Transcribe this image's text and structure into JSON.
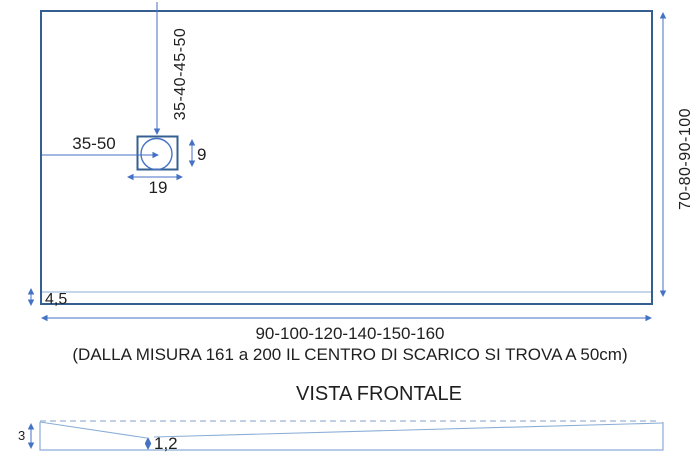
{
  "top_view": {
    "drain_center_from_top_label": "35-40-45-50",
    "drain_center_from_left_label": "35-50",
    "drain_box_height_label": "9",
    "drain_box_width_label": "19",
    "depth_range_label": "70-80-90-100",
    "border_thickness_label": "4,5",
    "width_range_label": "90-100-120-140-150-160",
    "width_note": "(DALLA MISURA 161 a 200 IL CENTRO DI SCARICO SI TROVA A 50cm)"
  },
  "front_view": {
    "title": "VISTA FRONTALE",
    "side_height_label": "3",
    "center_height_label": "1,2"
  },
  "colors": {
    "outline": "#365f91",
    "dimension_line": "#4472c4",
    "thin_line": "#8aaed6",
    "dashed_line": "#9db3d6",
    "text": "#1f1f1f"
  }
}
